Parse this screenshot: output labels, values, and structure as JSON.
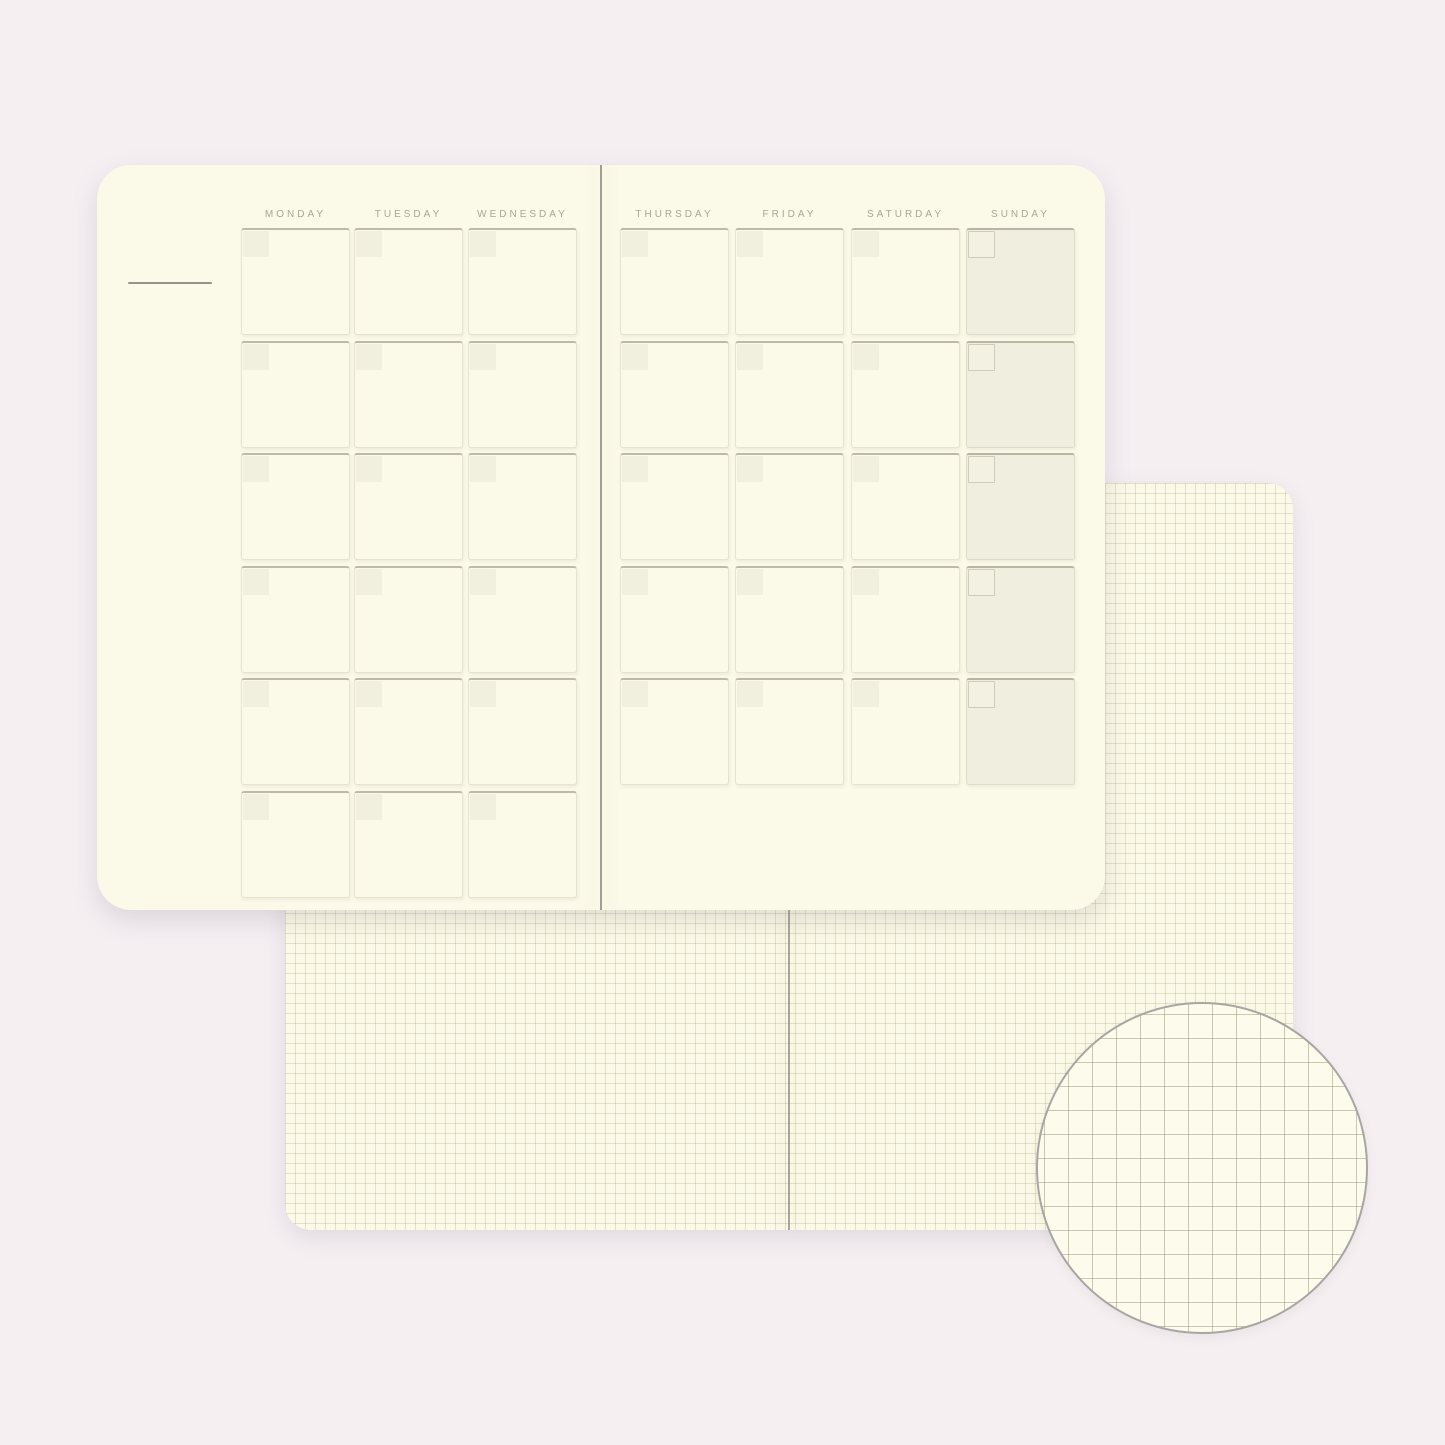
{
  "planner": {
    "columns": [
      {
        "label": "MONDAY",
        "page": "left",
        "rows": 6,
        "weekend": false
      },
      {
        "label": "TUESDAY",
        "page": "left",
        "rows": 6,
        "weekend": false
      },
      {
        "label": "WEDNESDAY",
        "page": "left",
        "rows": 6,
        "weekend": false
      },
      {
        "label": "THURSDAY",
        "page": "right",
        "rows": 5,
        "weekend": false
      },
      {
        "label": "FRIDAY",
        "page": "right",
        "rows": 5,
        "weekend": false
      },
      {
        "label": "SATURDAY",
        "page": "right",
        "rows": 5,
        "weekend": false
      },
      {
        "label": "SUNDAY",
        "page": "right",
        "rows": 5,
        "weekend": true
      }
    ]
  },
  "colors": {
    "background": "#F5EFF2",
    "paper": "#FBF9E7",
    "weekend_fill": "#EFEEDF",
    "date_box_fill": "#F1EFDD",
    "grid_line": "#DEDBC6",
    "detail_grid_line": "#C8C5AE",
    "label_text": "#A9A69A"
  }
}
